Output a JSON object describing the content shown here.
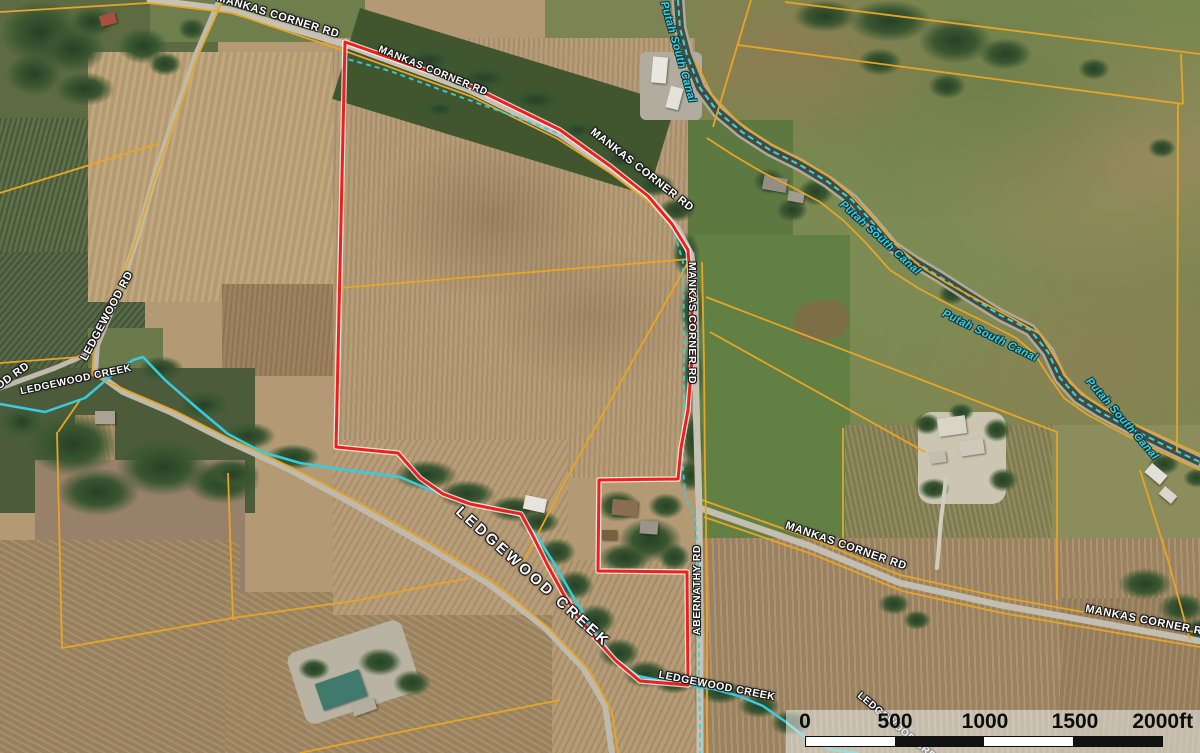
{
  "map": {
    "description": "Aerial parcel map, subject property outlined in red at Mankas Corner Rd / Abernathy Rd with Ledgewood Creek and Putah South Canal",
    "labels": [
      {
        "text": "MANKAS CORNER RD",
        "kind": "road",
        "x": 278,
        "y": 16,
        "rotate": 17,
        "size": 11
      },
      {
        "text": "MANKAS CORNER RD",
        "kind": "road",
        "x": 433,
        "y": 71,
        "rotate": 22,
        "size": 10
      },
      {
        "text": "MANKAS CORNER RD",
        "kind": "road",
        "x": 642,
        "y": 170,
        "rotate": 38,
        "size": 11
      },
      {
        "text": "MANKAS CORNER RD",
        "kind": "road",
        "x": 692,
        "y": 323,
        "rotate": 90,
        "size": 10.5
      },
      {
        "text": "MANKAS CORNER RD",
        "kind": "road",
        "x": 846,
        "y": 546,
        "rotate": 19,
        "size": 11
      },
      {
        "text": "MANKAS CORNER RD",
        "kind": "road",
        "x": 1148,
        "y": 621,
        "rotate": 11,
        "size": 11
      },
      {
        "text": "ABERNATHY RD",
        "kind": "road",
        "x": 697,
        "y": 590,
        "rotate": -90,
        "size": 10.5
      },
      {
        "text": "LEDGEWOOD RD",
        "kind": "road",
        "x": 107,
        "y": 316,
        "rotate": -62,
        "size": 11
      },
      {
        "text": "LEDGEWOOD RD",
        "kind": "road",
        "x": -12,
        "y": 394,
        "rotate": -36,
        "size": 11
      },
      {
        "text": "LEDGEWOOD CREEK",
        "kind": "road",
        "x": 76,
        "y": 380,
        "rotate": -12,
        "size": 10
      },
      {
        "text": "LEDGEWOOD CREEK",
        "kind": "road",
        "x": 533,
        "y": 577,
        "rotate": 42,
        "size": 15,
        "ls": 3
      },
      {
        "text": "LEDGEWOOD CREEK",
        "kind": "road",
        "x": 717,
        "y": 686,
        "rotate": 11,
        "size": 10.5
      },
      {
        "text": "LEDGEWOOD CREEK",
        "kind": "road",
        "x": 902,
        "y": 731,
        "rotate": 40,
        "size": 10
      },
      {
        "text": "Putah South Canal",
        "kind": "water",
        "x": 678,
        "y": 52,
        "rotate": 74,
        "size": 11
      },
      {
        "text": "Putah South Canal",
        "kind": "water",
        "x": 880,
        "y": 238,
        "rotate": 42,
        "size": 11
      },
      {
        "text": "Putah South Canal",
        "kind": "water",
        "x": 990,
        "y": 336,
        "rotate": 26,
        "size": 11
      },
      {
        "text": "Putah South Canal",
        "kind": "water",
        "x": 1122,
        "y": 419,
        "rotate": 49,
        "size": 11
      }
    ],
    "scale_bar": {
      "ticks": [
        "0",
        "500",
        "1000",
        "1500",
        "2000ft"
      ],
      "unit": "ft",
      "segment_feet": 500
    },
    "colors": {
      "parcel_boundary": "#f01f1b",
      "parcel_lines": "#e7a526",
      "water_line": "#36cde0",
      "road_label_color": "#ffffff",
      "water_label_color": "#35d2e2"
    }
  }
}
